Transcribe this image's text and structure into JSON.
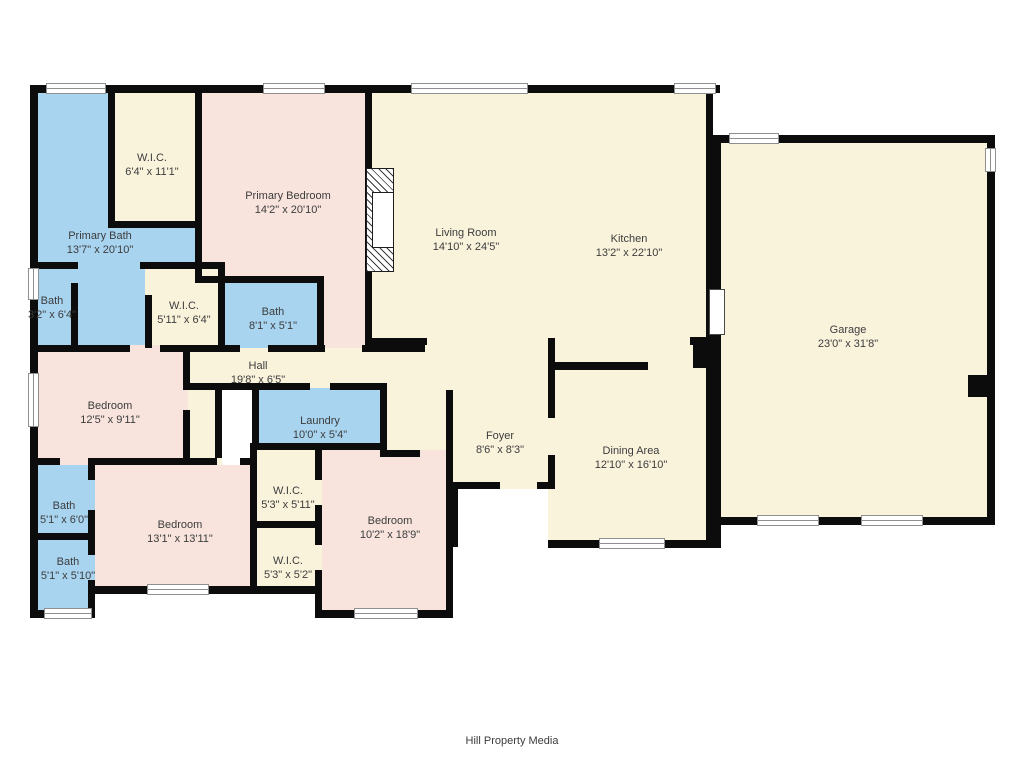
{
  "meta": {
    "width": 1024,
    "height": 768,
    "footer": "Hill Property Media"
  },
  "colors": {
    "wall": "#0c0c0c",
    "cream": "#FAF3DC",
    "pink": "#F8E4DD",
    "blue": "#A8D4F0",
    "text": "#3c3c3c",
    "background": "#ffffff"
  },
  "regions": [
    {
      "name": "living-kitchen",
      "color": "cream",
      "rect": [
        365,
        85,
        348,
        260
      ]
    },
    {
      "name": "garage",
      "color": "cream",
      "rect": [
        713,
        135,
        282,
        390
      ]
    },
    {
      "name": "hall",
      "color": "cream",
      "rect": [
        183,
        345,
        370,
        45
      ]
    },
    {
      "name": "foyer",
      "color": "cream",
      "rect": [
        425,
        345,
        128,
        144
      ]
    },
    {
      "name": "hall-nook",
      "color": "cream",
      "rect": [
        380,
        388,
        70,
        62
      ]
    },
    {
      "name": "dining-area",
      "color": "cream",
      "rect": [
        548,
        345,
        165,
        203
      ]
    },
    {
      "name": "primary-bath",
      "color": "blue",
      "rect": [
        30,
        85,
        173,
        263
      ]
    },
    {
      "name": "wic-primary",
      "color": "cream",
      "rect": [
        112,
        85,
        88,
        143
      ]
    },
    {
      "name": "primary-bedroom",
      "color": "pink",
      "rect": [
        195,
        85,
        177,
        198
      ]
    },
    {
      "name": "primary-bedroom-ext",
      "color": "pink",
      "rect": [
        318,
        276,
        54,
        72
      ]
    },
    {
      "name": "bath-3-2",
      "color": "blue",
      "rect": [
        30,
        262,
        48,
        86
      ]
    },
    {
      "name": "wic-5-11",
      "color": "cream",
      "rect": [
        145,
        262,
        80,
        86
      ]
    },
    {
      "name": "bath-8-1",
      "color": "blue",
      "rect": [
        222,
        276,
        102,
        72
      ]
    },
    {
      "name": "bedroom-12-5",
      "color": "pink",
      "rect": [
        30,
        345,
        160,
        120
      ]
    },
    {
      "name": "hall-alcove",
      "color": "cream",
      "rect": [
        188,
        390,
        34,
        75
      ]
    },
    {
      "name": "laundry",
      "color": "blue",
      "rect": [
        252,
        388,
        135,
        62
      ]
    },
    {
      "name": "wic-5-3-5-11",
      "color": "cream",
      "rect": [
        250,
        450,
        72,
        78
      ]
    },
    {
      "name": "wic-5-3-5-2",
      "color": "cream",
      "rect": [
        250,
        528,
        72,
        65
      ]
    },
    {
      "name": "bedroom-13-1",
      "color": "pink",
      "rect": [
        95,
        465,
        160,
        128
      ]
    },
    {
      "name": "bath-5-1-6-0",
      "color": "blue",
      "rect": [
        30,
        465,
        65,
        75
      ]
    },
    {
      "name": "bath-5-1-5-10",
      "color": "blue",
      "rect": [
        30,
        540,
        65,
        78
      ]
    },
    {
      "name": "bedroom-10-2",
      "color": "pink",
      "rect": [
        322,
        450,
        131,
        167
      ]
    }
  ],
  "walls": [
    [
      30,
      85,
      690,
      8
    ],
    [
      713,
      135,
      282,
      8
    ],
    [
      108,
      221,
      92,
      7
    ],
    [
      30,
      262,
      48,
      7
    ],
    [
      140,
      262,
      85,
      7
    ],
    [
      195,
      276,
      129,
      7
    ],
    [
      30,
      345,
      100,
      7
    ],
    [
      160,
      345,
      80,
      7
    ],
    [
      268,
      345,
      57,
      7
    ],
    [
      362,
      345,
      63,
      7
    ],
    [
      365,
      338,
      62,
      7
    ],
    [
      183,
      383,
      127,
      7
    ],
    [
      330,
      383,
      57,
      7
    ],
    [
      30,
      458,
      30,
      7
    ],
    [
      88,
      458,
      129,
      7
    ],
    [
      240,
      458,
      17,
      7
    ],
    [
      30,
      533,
      65,
      7
    ],
    [
      30,
      610,
      65,
      8
    ],
    [
      95,
      586,
      227,
      8
    ],
    [
      322,
      610,
      131,
      8
    ],
    [
      250,
      521,
      72,
      7
    ],
    [
      250,
      443,
      137,
      7
    ],
    [
      380,
      450,
      40,
      7
    ],
    [
      450,
      482,
      50,
      7
    ],
    [
      537,
      482,
      18,
      7
    ],
    [
      548,
      362,
      100,
      8
    ],
    [
      548,
      540,
      165,
      8
    ],
    [
      713,
      517,
      282,
      8
    ],
    [
      690,
      337,
      23,
      8
    ],
    [
      693,
      337,
      20,
      31
    ],
    [
      968,
      375,
      22,
      22
    ],
    [
      30,
      85,
      8,
      533
    ],
    [
      108,
      85,
      7,
      143
    ],
    [
      195,
      85,
      7,
      198
    ],
    [
      365,
      85,
      7,
      260
    ],
    [
      706,
      85,
      7,
      260
    ],
    [
      713,
      135,
      8,
      157
    ],
    [
      713,
      335,
      8,
      213
    ],
    [
      987,
      135,
      8,
      390
    ],
    [
      71,
      283,
      7,
      65
    ],
    [
      145,
      295,
      7,
      53
    ],
    [
      218,
      262,
      7,
      86
    ],
    [
      317,
      276,
      7,
      76
    ],
    [
      183,
      345,
      7,
      40
    ],
    [
      183,
      410,
      7,
      55
    ],
    [
      252,
      390,
      7,
      60
    ],
    [
      380,
      388,
      7,
      62
    ],
    [
      215,
      390,
      7,
      68
    ],
    [
      250,
      450,
      7,
      143
    ],
    [
      315,
      450,
      7,
      30
    ],
    [
      315,
      505,
      7,
      40
    ],
    [
      315,
      570,
      7,
      23
    ],
    [
      446,
      390,
      7,
      227
    ],
    [
      548,
      338,
      7,
      80
    ],
    [
      548,
      455,
      7,
      34
    ],
    [
      706,
      368,
      7,
      180
    ],
    [
      88,
      465,
      7,
      15
    ],
    [
      88,
      510,
      7,
      30
    ],
    [
      88,
      540,
      7,
      15
    ],
    [
      88,
      580,
      7,
      28
    ],
    [
      450,
      482,
      8,
      65
    ],
    [
      88,
      586,
      7,
      32
    ],
    [
      315,
      586,
      7,
      32
    ]
  ],
  "windows": [
    {
      "rect": [
        46,
        83,
        60,
        11
      ],
      "o": "h"
    },
    {
      "rect": [
        263,
        83,
        62,
        11
      ],
      "o": "h"
    },
    {
      "rect": [
        411,
        83,
        117,
        11
      ],
      "o": "h"
    },
    {
      "rect": [
        674,
        83,
        42,
        11
      ],
      "o": "h"
    },
    {
      "rect": [
        729,
        133,
        50,
        11
      ],
      "o": "h"
    },
    {
      "rect": [
        757,
        515,
        62,
        11
      ],
      "o": "h"
    },
    {
      "rect": [
        861,
        515,
        62,
        11
      ],
      "o": "h"
    },
    {
      "rect": [
        985,
        148,
        11,
        24
      ],
      "o": "v"
    },
    {
      "rect": [
        28,
        268,
        11,
        32
      ],
      "o": "v"
    },
    {
      "rect": [
        28,
        373,
        11,
        54
      ],
      "o": "v"
    },
    {
      "rect": [
        44,
        608,
        48,
        11
      ],
      "o": "h"
    },
    {
      "rect": [
        147,
        584,
        62,
        11
      ],
      "o": "h"
    },
    {
      "rect": [
        354,
        608,
        64,
        11
      ],
      "o": "h"
    },
    {
      "rect": [
        599,
        538,
        66,
        11
      ],
      "o": "h"
    }
  ],
  "door_leaf": {
    "rect": [
      709,
      289,
      16,
      46
    ]
  },
  "fireplace": {
    "rect": [
      366,
      168,
      28,
      104
    ],
    "inner": [
      372,
      192,
      22,
      56
    ]
  },
  "labels": [
    {
      "name": "wic-primary",
      "room": "W.I.C.",
      "dims": "6'4\" x 11'1\"",
      "x": 152,
      "y": 165
    },
    {
      "name": "primary-bath",
      "room": "Primary Bath",
      "dims": "13'7\" x 20'10\"",
      "x": 100,
      "y": 243
    },
    {
      "name": "primary-bedroom",
      "room": "Primary Bedroom",
      "dims": "14'2\" x 20'10\"",
      "x": 288,
      "y": 203
    },
    {
      "name": "living-room",
      "room": "Living Room",
      "dims": "14'10\" x 24'5\"",
      "x": 466,
      "y": 240
    },
    {
      "name": "kitchen",
      "room": "Kitchen",
      "dims": "13'2\" x 22'10\"",
      "x": 629,
      "y": 246
    },
    {
      "name": "garage",
      "room": "Garage",
      "dims": "23'0\" x 31'8\"",
      "x": 848,
      "y": 337
    },
    {
      "name": "bath-3-2",
      "room": "Bath",
      "dims": "3'2\" x 6'4\"",
      "x": 52,
      "y": 308
    },
    {
      "name": "wic-5-11",
      "room": "W.I.C.",
      "dims": "5'11\" x 6'4\"",
      "x": 184,
      "y": 313
    },
    {
      "name": "bath-8-1",
      "room": "Bath",
      "dims": "8'1\" x 5'1\"",
      "x": 273,
      "y": 319
    },
    {
      "name": "hall",
      "room": "Hall",
      "dims": "19'8\" x 6'5\"",
      "x": 258,
      "y": 373
    },
    {
      "name": "bedroom-12-5",
      "room": "Bedroom",
      "dims": "12'5\" x 9'11\"",
      "x": 110,
      "y": 413
    },
    {
      "name": "laundry",
      "room": "Laundry",
      "dims": "10'0\" x 5'4\"",
      "x": 320,
      "y": 428
    },
    {
      "name": "foyer",
      "room": "Foyer",
      "dims": "8'6\" x 8'3\"",
      "x": 500,
      "y": 443
    },
    {
      "name": "dining-area",
      "room": "Dining Area",
      "dims": "12'10\" x 16'10\"",
      "x": 631,
      "y": 458
    },
    {
      "name": "bath-5-1-6-0",
      "room": "Bath",
      "dims": "5'1\" x 6'0\"",
      "x": 64,
      "y": 513
    },
    {
      "name": "bath-5-1-5-10",
      "room": "Bath",
      "dims": "5'1\" x 5'10\"",
      "x": 68,
      "y": 569
    },
    {
      "name": "bedroom-13-1",
      "room": "Bedroom",
      "dims": "13'1\" x 13'11\"",
      "x": 180,
      "y": 532
    },
    {
      "name": "wic-5-3-5-11",
      "room": "W.I.C.",
      "dims": "5'3\" x 5'11\"",
      "x": 288,
      "y": 498
    },
    {
      "name": "wic-5-3-5-2",
      "room": "W.I.C.",
      "dims": "5'3\" x 5'2\"",
      "x": 288,
      "y": 568
    },
    {
      "name": "bedroom-10-2",
      "room": "Bedroom",
      "dims": "10'2\" x 18'9\"",
      "x": 390,
      "y": 528
    }
  ]
}
